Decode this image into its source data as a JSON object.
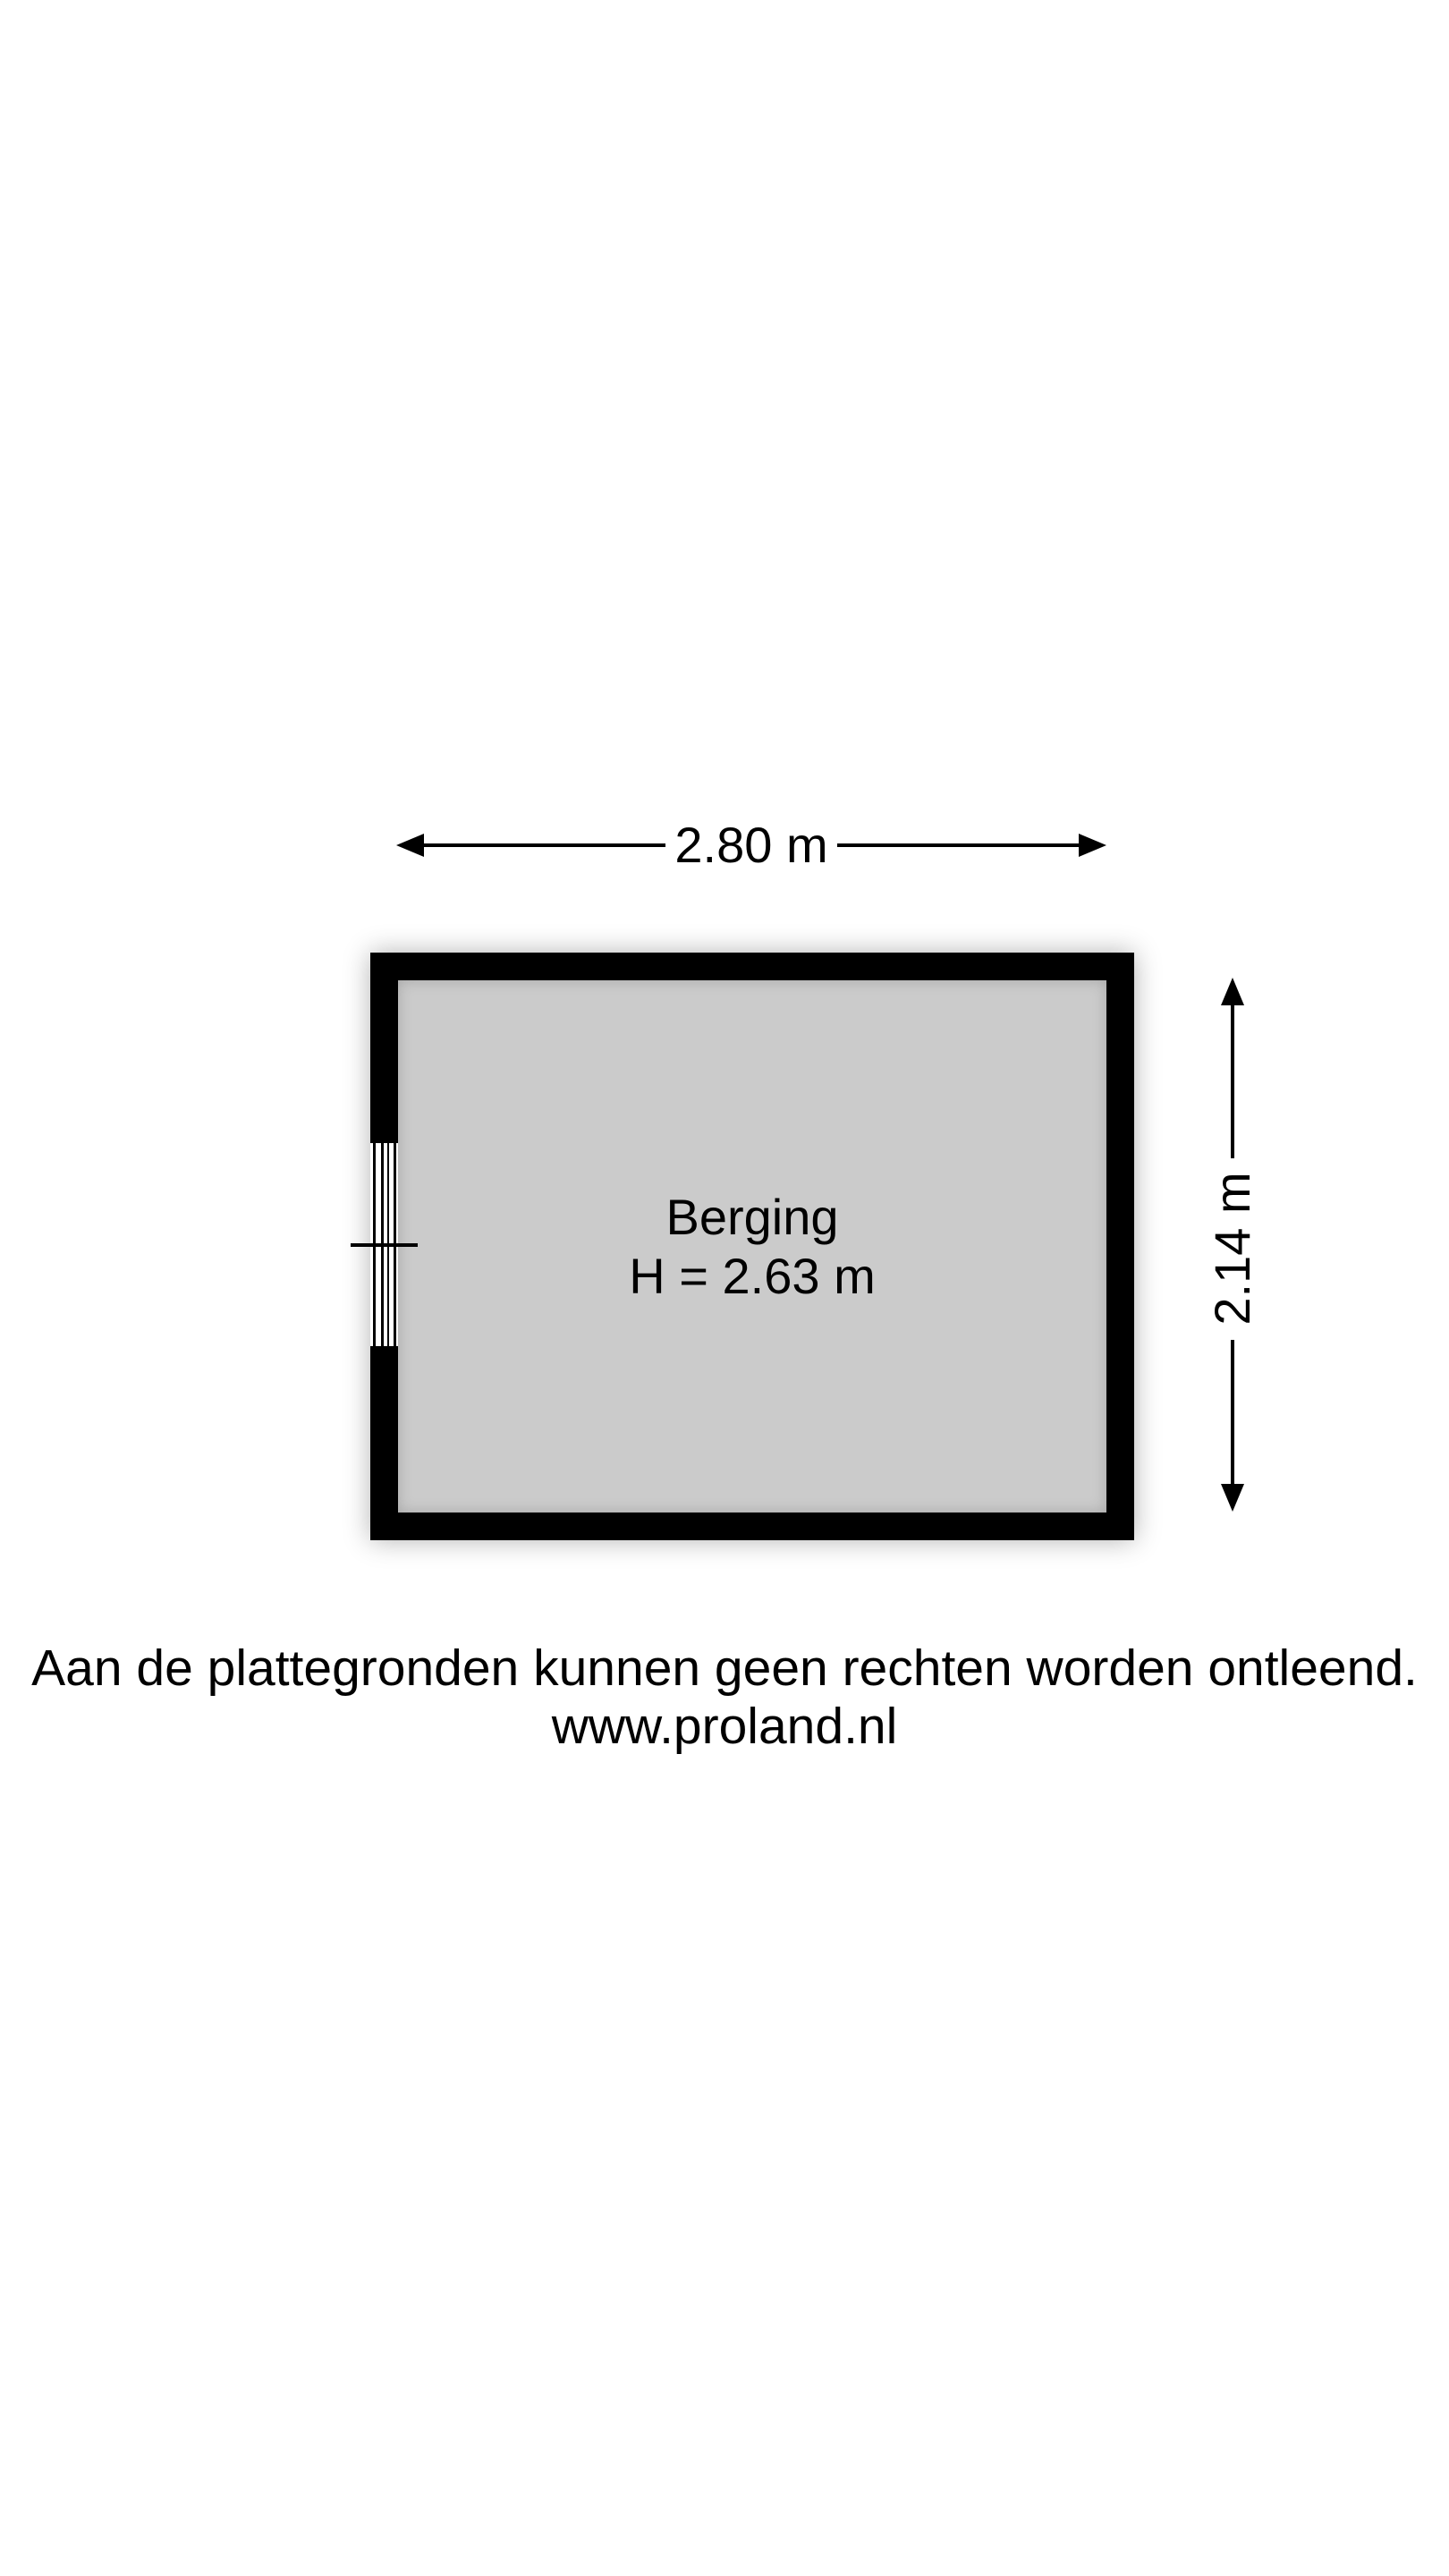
{
  "floorplan": {
    "room": {
      "name": "Berging",
      "ceiling_height_label": "H = 2.63 m"
    },
    "dimensions": {
      "width_label": "2.80 m",
      "depth_label": "2.14 m"
    },
    "disclaimer": {
      "line1": "Aan de plattegronden kunnen geen rechten worden ontleend.",
      "line2": "www.proland.nl"
    },
    "colors": {
      "wall": "#000000",
      "floor": "#cbcbcb",
      "background": "#ffffff"
    }
  }
}
